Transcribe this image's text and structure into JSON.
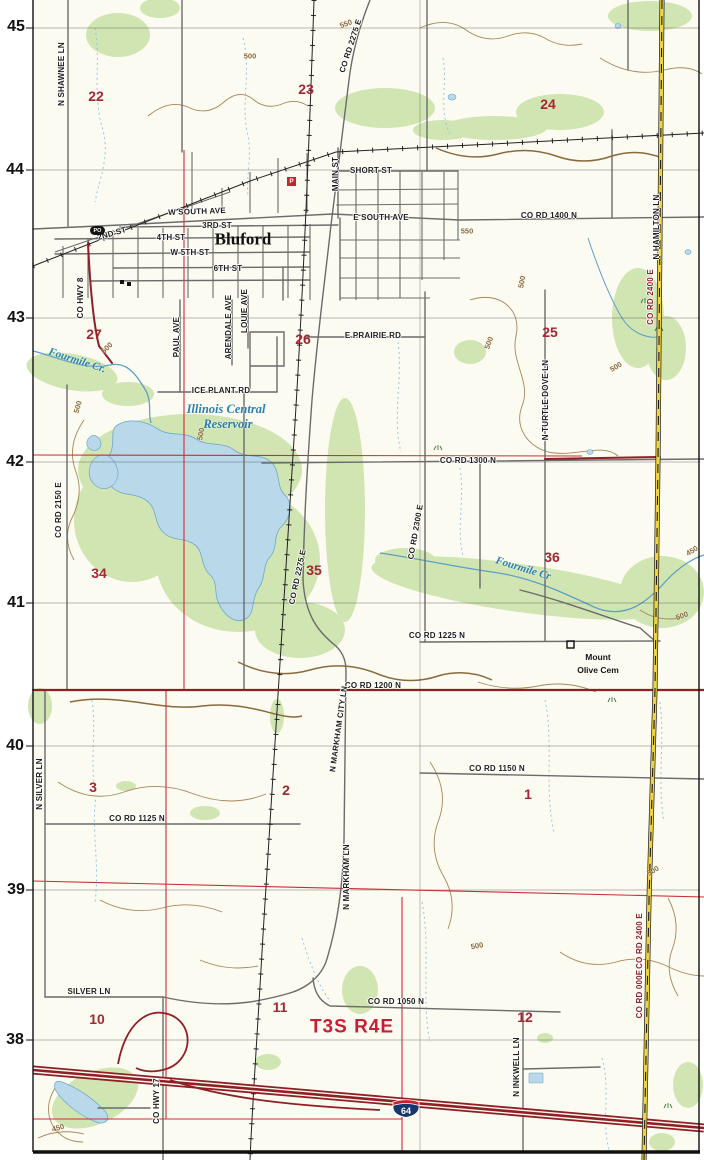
{
  "map_title": "Bluford quadrangle topographic map",
  "colors": {
    "paper": "#fcfbf1",
    "vegetation_green": "#d0e5b2",
    "water_fill": "#b9d8ea",
    "water_line": "#6ea9cc",
    "contour_brown": "#a8865a",
    "road_gray": "#6b6b6b",
    "major_road_dark_red": "#8e1f24",
    "section_line_red": "#cf2b36",
    "county_road_yellow": "#f0d342",
    "section_number_red": "#a12733",
    "township_red": "#c51f35",
    "water_label_blue": "#2a7fae"
  },
  "badges": {
    "post_office": "PO",
    "p": "P",
    "interstate": "64"
  },
  "cemetery": {
    "line1": "Mount",
    "line2": "Olive Cem"
  },
  "labels": [
    {
      "t": "45",
      "x": 16,
      "y": 27,
      "c": "edge"
    },
    {
      "t": "44",
      "x": 15,
      "y": 170,
      "c": "edge"
    },
    {
      "t": "43",
      "x": 16,
      "y": 318,
      "c": "edge"
    },
    {
      "t": "42",
      "x": 15,
      "y": 462,
      "c": "edge"
    },
    {
      "t": "41",
      "x": 16,
      "y": 603,
      "c": "edge"
    },
    {
      "t": "40",
      "x": 15,
      "y": 746,
      "c": "edge"
    },
    {
      "t": "39",
      "x": 16,
      "y": 890,
      "c": "edge"
    },
    {
      "t": "38",
      "x": 15,
      "y": 1040,
      "c": "edge"
    },
    {
      "t": "22",
      "x": 96,
      "y": 96,
      "c": "section"
    },
    {
      "t": "23",
      "x": 306,
      "y": 89,
      "c": "section"
    },
    {
      "t": "24",
      "x": 548,
      "y": 104,
      "c": "section"
    },
    {
      "t": "27",
      "x": 94,
      "y": 334,
      "c": "section"
    },
    {
      "t": "26",
      "x": 303,
      "y": 339,
      "c": "section"
    },
    {
      "t": "25",
      "x": 550,
      "y": 332,
      "c": "section"
    },
    {
      "t": "34",
      "x": 99,
      "y": 573,
      "c": "section"
    },
    {
      "t": "35",
      "x": 314,
      "y": 570,
      "c": "section"
    },
    {
      "t": "36",
      "x": 552,
      "y": 557,
      "c": "section"
    },
    {
      "t": "3",
      "x": 93,
      "y": 787,
      "c": "section"
    },
    {
      "t": "2",
      "x": 286,
      "y": 790,
      "c": "section"
    },
    {
      "t": "1",
      "x": 528,
      "y": 794,
      "c": "section"
    },
    {
      "t": "10",
      "x": 97,
      "y": 1019,
      "c": "section"
    },
    {
      "t": "11",
      "x": 280,
      "y": 1007,
      "c": "section"
    },
    {
      "t": "12",
      "x": 525,
      "y": 1017,
      "c": "section"
    },
    {
      "t": "T3S R4E",
      "x": 352,
      "y": 1027,
      "c": "township"
    },
    {
      "t": "Bluford",
      "x": 243,
      "y": 239,
      "c": "town"
    },
    {
      "t": "Fourmile Cr.",
      "x": 77,
      "y": 361,
      "r": 18,
      "c": "water"
    },
    {
      "t": "Illinois Central",
      "x": 226,
      "y": 409,
      "c": "water2"
    },
    {
      "t": "Reservoir",
      "x": 228,
      "y": 424,
      "c": "water2"
    },
    {
      "t": "Fourmile Cr",
      "x": 523,
      "y": 569,
      "r": 17,
      "c": "water"
    },
    {
      "t": "N SHAWNEE LN",
      "x": 62,
      "y": 74,
      "r": -90,
      "c": "road"
    },
    {
      "t": "CO RD 2275 E",
      "x": 351,
      "y": 46,
      "r": -72,
      "c": "road"
    },
    {
      "t": "SHORT ST",
      "x": 371,
      "y": 171,
      "c": "road"
    },
    {
      "t": "MAIN ST",
      "x": 336,
      "y": 174,
      "r": -90,
      "c": "road"
    },
    {
      "t": "W SOUTH AVE",
      "x": 197,
      "y": 212,
      "r": -2,
      "c": "road"
    },
    {
      "t": "3RD ST",
      "x": 217,
      "y": 226,
      "c": "road"
    },
    {
      "t": "4TH ST",
      "x": 171,
      "y": 238,
      "c": "road"
    },
    {
      "t": "W 5TH ST",
      "x": 190,
      "y": 253,
      "c": "road"
    },
    {
      "t": "6TH ST",
      "x": 228,
      "y": 269,
      "c": "road"
    },
    {
      "t": "2ND ST",
      "x": 112,
      "y": 234,
      "r": -16,
      "c": "road"
    },
    {
      "t": "E SOUTH AVE",
      "x": 381,
      "y": 218,
      "c": "road"
    },
    {
      "t": "CO RD 1400 N",
      "x": 549,
      "y": 216,
      "c": "road"
    },
    {
      "t": "CO HWY 8",
      "x": 81,
      "y": 298,
      "r": -90,
      "c": "road"
    },
    {
      "t": "PAUL AVE",
      "x": 177,
      "y": 337,
      "r": -90,
      "c": "road"
    },
    {
      "t": "ARENDALE AVE",
      "x": 229,
      "y": 327,
      "r": -90,
      "c": "road"
    },
    {
      "t": "LOUIE AVE",
      "x": 245,
      "y": 311,
      "r": -90,
      "c": "road"
    },
    {
      "t": "ICE PLANT RD",
      "x": 221,
      "y": 391,
      "c": "road"
    },
    {
      "t": "E PRAIRIE RD",
      "x": 373,
      "y": 336,
      "c": "road"
    },
    {
      "t": "CO RD 2150 E",
      "x": 59,
      "y": 510,
      "r": -90,
      "c": "road"
    },
    {
      "t": "CO RD 2275 E",
      "x": 298,
      "y": 577,
      "r": -78,
      "c": "road"
    },
    {
      "t": "CO RD 2300 E",
      "x": 416,
      "y": 532,
      "r": -80,
      "c": "road"
    },
    {
      "t": "N TURTLE DOVE LN",
      "x": 546,
      "y": 400,
      "r": -90,
      "c": "road"
    },
    {
      "t": "CO RD 1300 N",
      "x": 468,
      "y": 461,
      "c": "road"
    },
    {
      "t": "CO RD 1225 N",
      "x": 437,
      "y": 636,
      "c": "road"
    },
    {
      "t": "CO RD 1200 N",
      "x": 373,
      "y": 686,
      "c": "road"
    },
    {
      "t": "N MARKHAM CITY LN",
      "x": 339,
      "y": 729,
      "r": -82,
      "c": "road"
    },
    {
      "t": "N MARKHAM LN",
      "x": 347,
      "y": 877,
      "r": -90,
      "c": "road"
    },
    {
      "t": "CO RD 1150 N",
      "x": 497,
      "y": 769,
      "c": "road"
    },
    {
      "t": "CO RD 1125 N",
      "x": 137,
      "y": 819,
      "c": "road"
    },
    {
      "t": "N SILVER LN",
      "x": 40,
      "y": 784,
      "r": -90,
      "c": "road"
    },
    {
      "t": "SILVER LN",
      "x": 89,
      "y": 992,
      "c": "road"
    },
    {
      "t": "CO RD 1050 N",
      "x": 396,
      "y": 1002,
      "c": "road"
    },
    {
      "t": "CO HWY 17",
      "x": 157,
      "y": 1101,
      "r": -90,
      "c": "road"
    },
    {
      "t": "N INKWELL LN",
      "x": 517,
      "y": 1067,
      "r": -90,
      "c": "road"
    },
    {
      "t": "N HAMILTON LN",
      "x": 657,
      "y": 227,
      "r": -90,
      "c": "road"
    },
    {
      "t": "CO RD 2400 E",
      "x": 651,
      "y": 297,
      "r": -90,
      "c": "roadred"
    },
    {
      "t": "CO RD 2400 E",
      "x": 640,
      "y": 941,
      "r": -90,
      "c": "roadred"
    },
    {
      "t": "CO RD 000E",
      "x": 640,
      "y": 994,
      "r": -90,
      "c": "roadred"
    },
    {
      "t": "Mount",
      "x": 598,
      "y": 657,
      "c": "poi"
    },
    {
      "t": "Olive Cem",
      "x": 598,
      "y": 670,
      "c": "poi"
    },
    {
      "t": "550",
      "x": 346,
      "y": 24,
      "r": -20,
      "c": "contour"
    },
    {
      "t": "550",
      "x": 467,
      "y": 231,
      "c": "contour"
    },
    {
      "t": "500",
      "x": 250,
      "y": 56,
      "c": "contour"
    },
    {
      "t": "500",
      "x": 522,
      "y": 282,
      "r": -80,
      "c": "contour"
    },
    {
      "t": "500",
      "x": 616,
      "y": 367,
      "r": -30,
      "c": "contour"
    },
    {
      "t": "500",
      "x": 489,
      "y": 343,
      "r": -70,
      "c": "contour"
    },
    {
      "t": "500",
      "x": 107,
      "y": 348,
      "r": -45,
      "c": "contour"
    },
    {
      "t": "500",
      "x": 201,
      "y": 434,
      "r": -80,
      "c": "contour"
    },
    {
      "t": "500",
      "x": 78,
      "y": 407,
      "r": -75,
      "c": "contour"
    },
    {
      "t": "500",
      "x": 653,
      "y": 871,
      "r": -30,
      "c": "contour"
    },
    {
      "t": "500",
      "x": 477,
      "y": 946,
      "r": -10,
      "c": "contour"
    },
    {
      "t": "500",
      "x": 682,
      "y": 616,
      "r": -20,
      "c": "contour"
    },
    {
      "t": "450",
      "x": 58,
      "y": 1128,
      "r": -15,
      "c": "contour"
    },
    {
      "t": "450",
      "x": 692,
      "y": 551,
      "r": -30,
      "c": "contour"
    }
  ]
}
